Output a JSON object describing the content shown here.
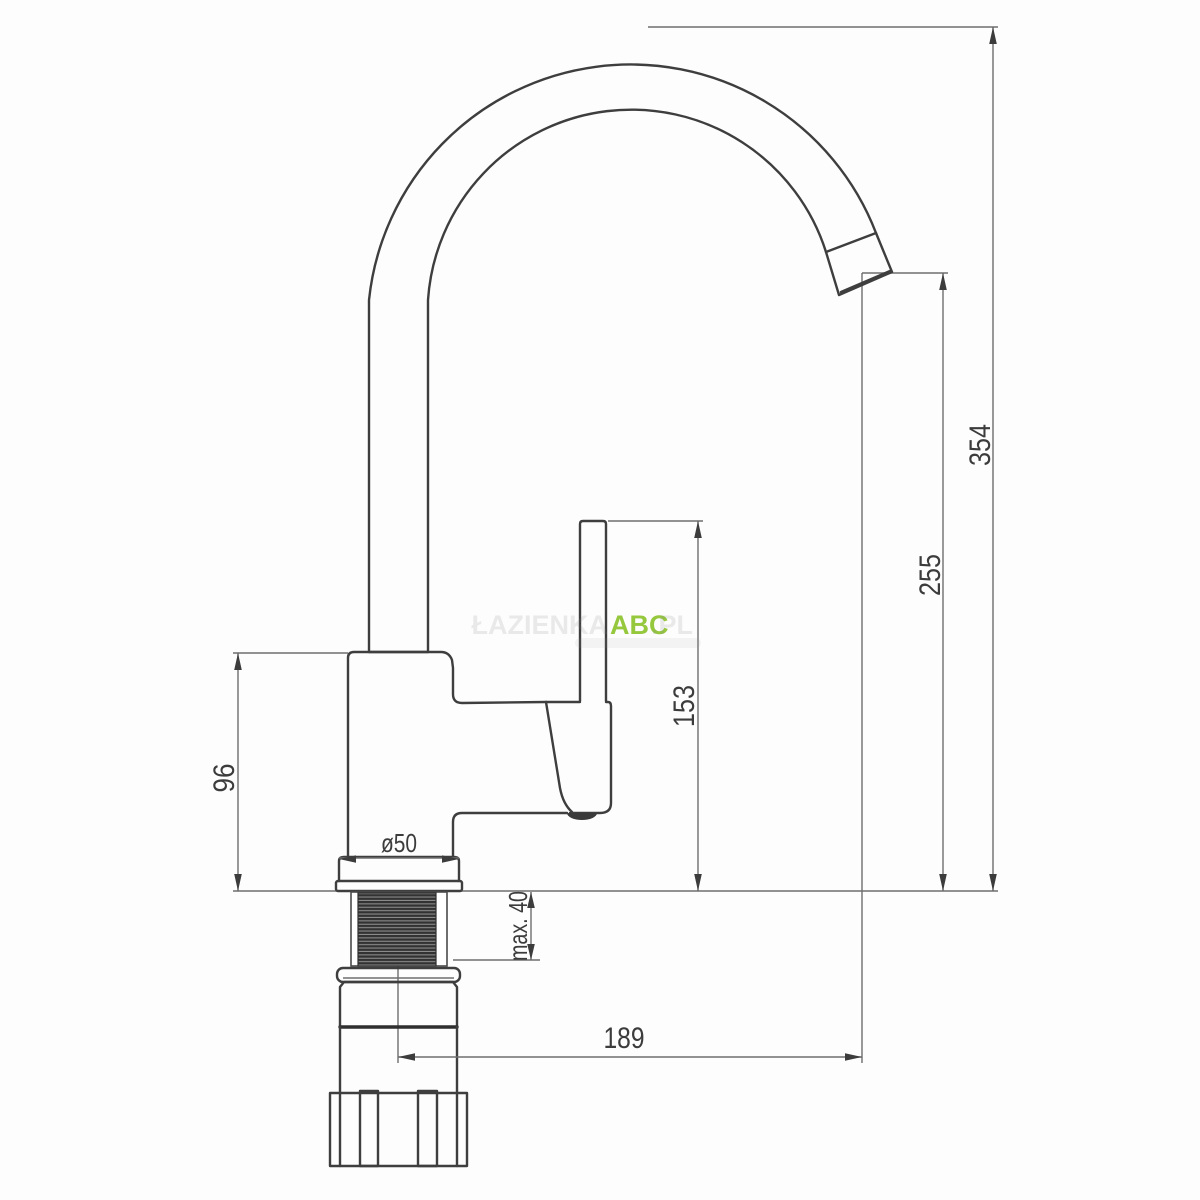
{
  "drawing": {
    "kind": "faucet-technical-dimension-drawing",
    "labels": {
      "dim_total_height": "354",
      "dim_spout_outlet_height": "255",
      "dim_handle_top_height": "153",
      "dim_body_height": "96",
      "dim_base_diameter": "ø50",
      "dim_max_counter_thickness": "max. 40",
      "dim_spout_reach": "189"
    }
  },
  "watermark": {
    "prefix": "ŁAZIENKA",
    "brand": "ABC",
    "suffix": ".PL",
    "brand_color": "#96c83e"
  },
  "colors": {
    "outline": "#3e3e3e",
    "dimension_line": "#6e6e6e",
    "thread_dark": "#323232",
    "thread_light": "#8b8b8b",
    "background": "#fdfdfd"
  }
}
